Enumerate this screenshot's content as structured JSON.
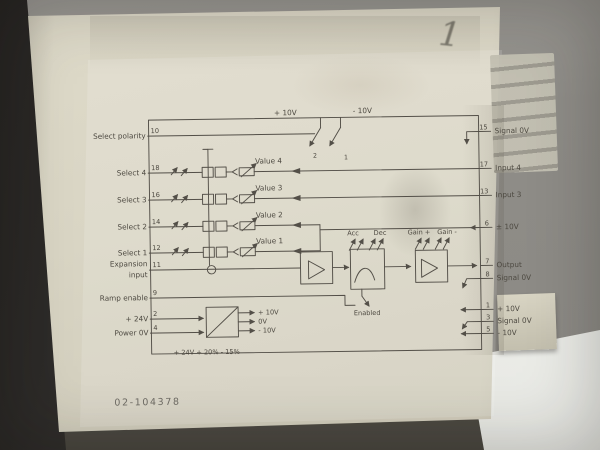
{
  "photo": {
    "handwritten_mark": "1",
    "part_number": "02-104378"
  },
  "colors": {
    "module_body": "#d8d4c3",
    "background_gray": "#908e89",
    "schematic_line": "#534f48",
    "paper_white": "#edeeea",
    "dark_edge": "#3d3b38"
  },
  "schematic": {
    "rails": {
      "plus": "+ 10V",
      "minus": "- 10V"
    },
    "polarity_switch": {
      "left_num": "2",
      "right_num": "1"
    },
    "left_pins": [
      {
        "label": "Select polarity",
        "pin": "10"
      },
      {
        "label": "Select 4",
        "pin": "18"
      },
      {
        "label": "Select 3",
        "pin": "16"
      },
      {
        "label": "Select 2",
        "pin": "14"
      },
      {
        "label": "Select 1",
        "pin": "12"
      },
      {
        "label": "Expansion",
        "label2": "input",
        "pin": "11"
      },
      {
        "label": "Ramp enable",
        "pin": "9"
      },
      {
        "label": "+ 24V",
        "pin": "2"
      },
      {
        "label": "Power 0V",
        "pin": "4"
      }
    ],
    "right_pins": [
      {
        "pin": "15",
        "label": "Signal 0V"
      },
      {
        "pin": "17",
        "label": "Input 4"
      },
      {
        "pin": "13",
        "label": "Input 3"
      },
      {
        "pin": "6",
        "label": "± 10V"
      },
      {
        "pin": "7",
        "label": "Output"
      },
      {
        "pin": "8",
        "label": "Signal 0V"
      },
      {
        "pin": "1",
        "label": "+ 10V"
      },
      {
        "pin": "3",
        "label": "Signal 0V"
      },
      {
        "pin": "5",
        "label": "- 10V"
      }
    ],
    "value_pots": [
      "Value 4",
      "Value 3",
      "Value 2",
      "Value 1"
    ],
    "trim_pots": [
      "Acc",
      "Dec",
      "Gain +",
      "Gain -"
    ],
    "enabled_label": "Enabled",
    "psu_outputs": [
      "+ 10V",
      "0V",
      "- 10V"
    ],
    "psu_note": "+ 24V + 20% - 15%"
  }
}
